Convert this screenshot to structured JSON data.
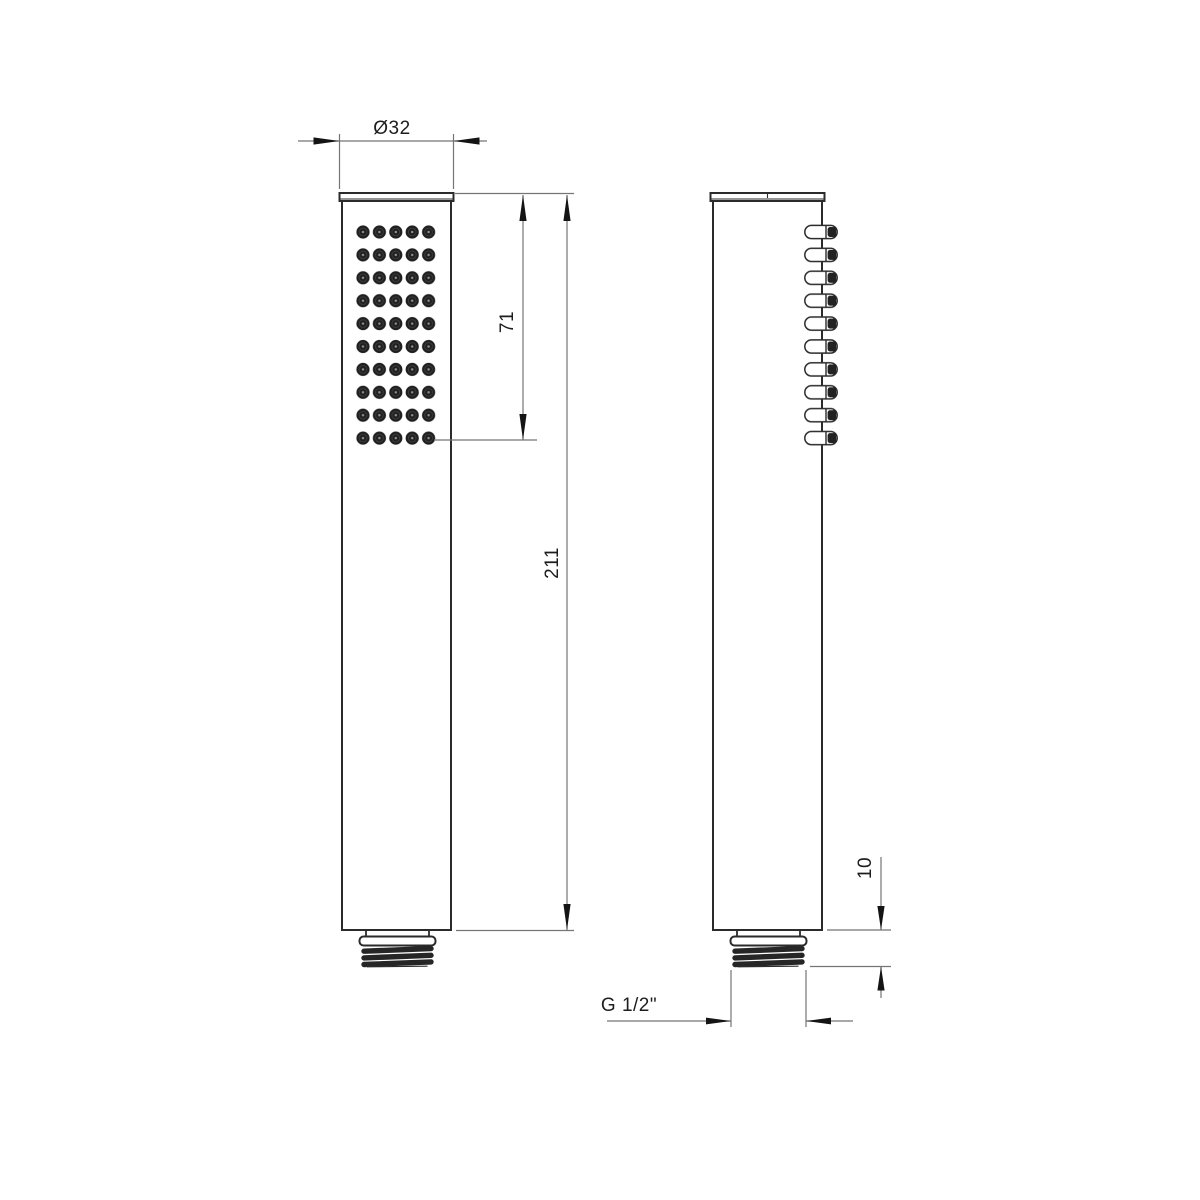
{
  "drawing": {
    "type": "technical-drawing",
    "subject": "hand-shower",
    "dimensions": {
      "head_diameter": "Ø32",
      "spray_face_length": "71",
      "total_length": "211",
      "thread_length": "10",
      "thread_size": "G 1/2\""
    },
    "colors": {
      "background": "#ffffff",
      "outline": "#2b2b2b",
      "dimension_lines": "#757575",
      "text": "#1d1d1d"
    }
  }
}
